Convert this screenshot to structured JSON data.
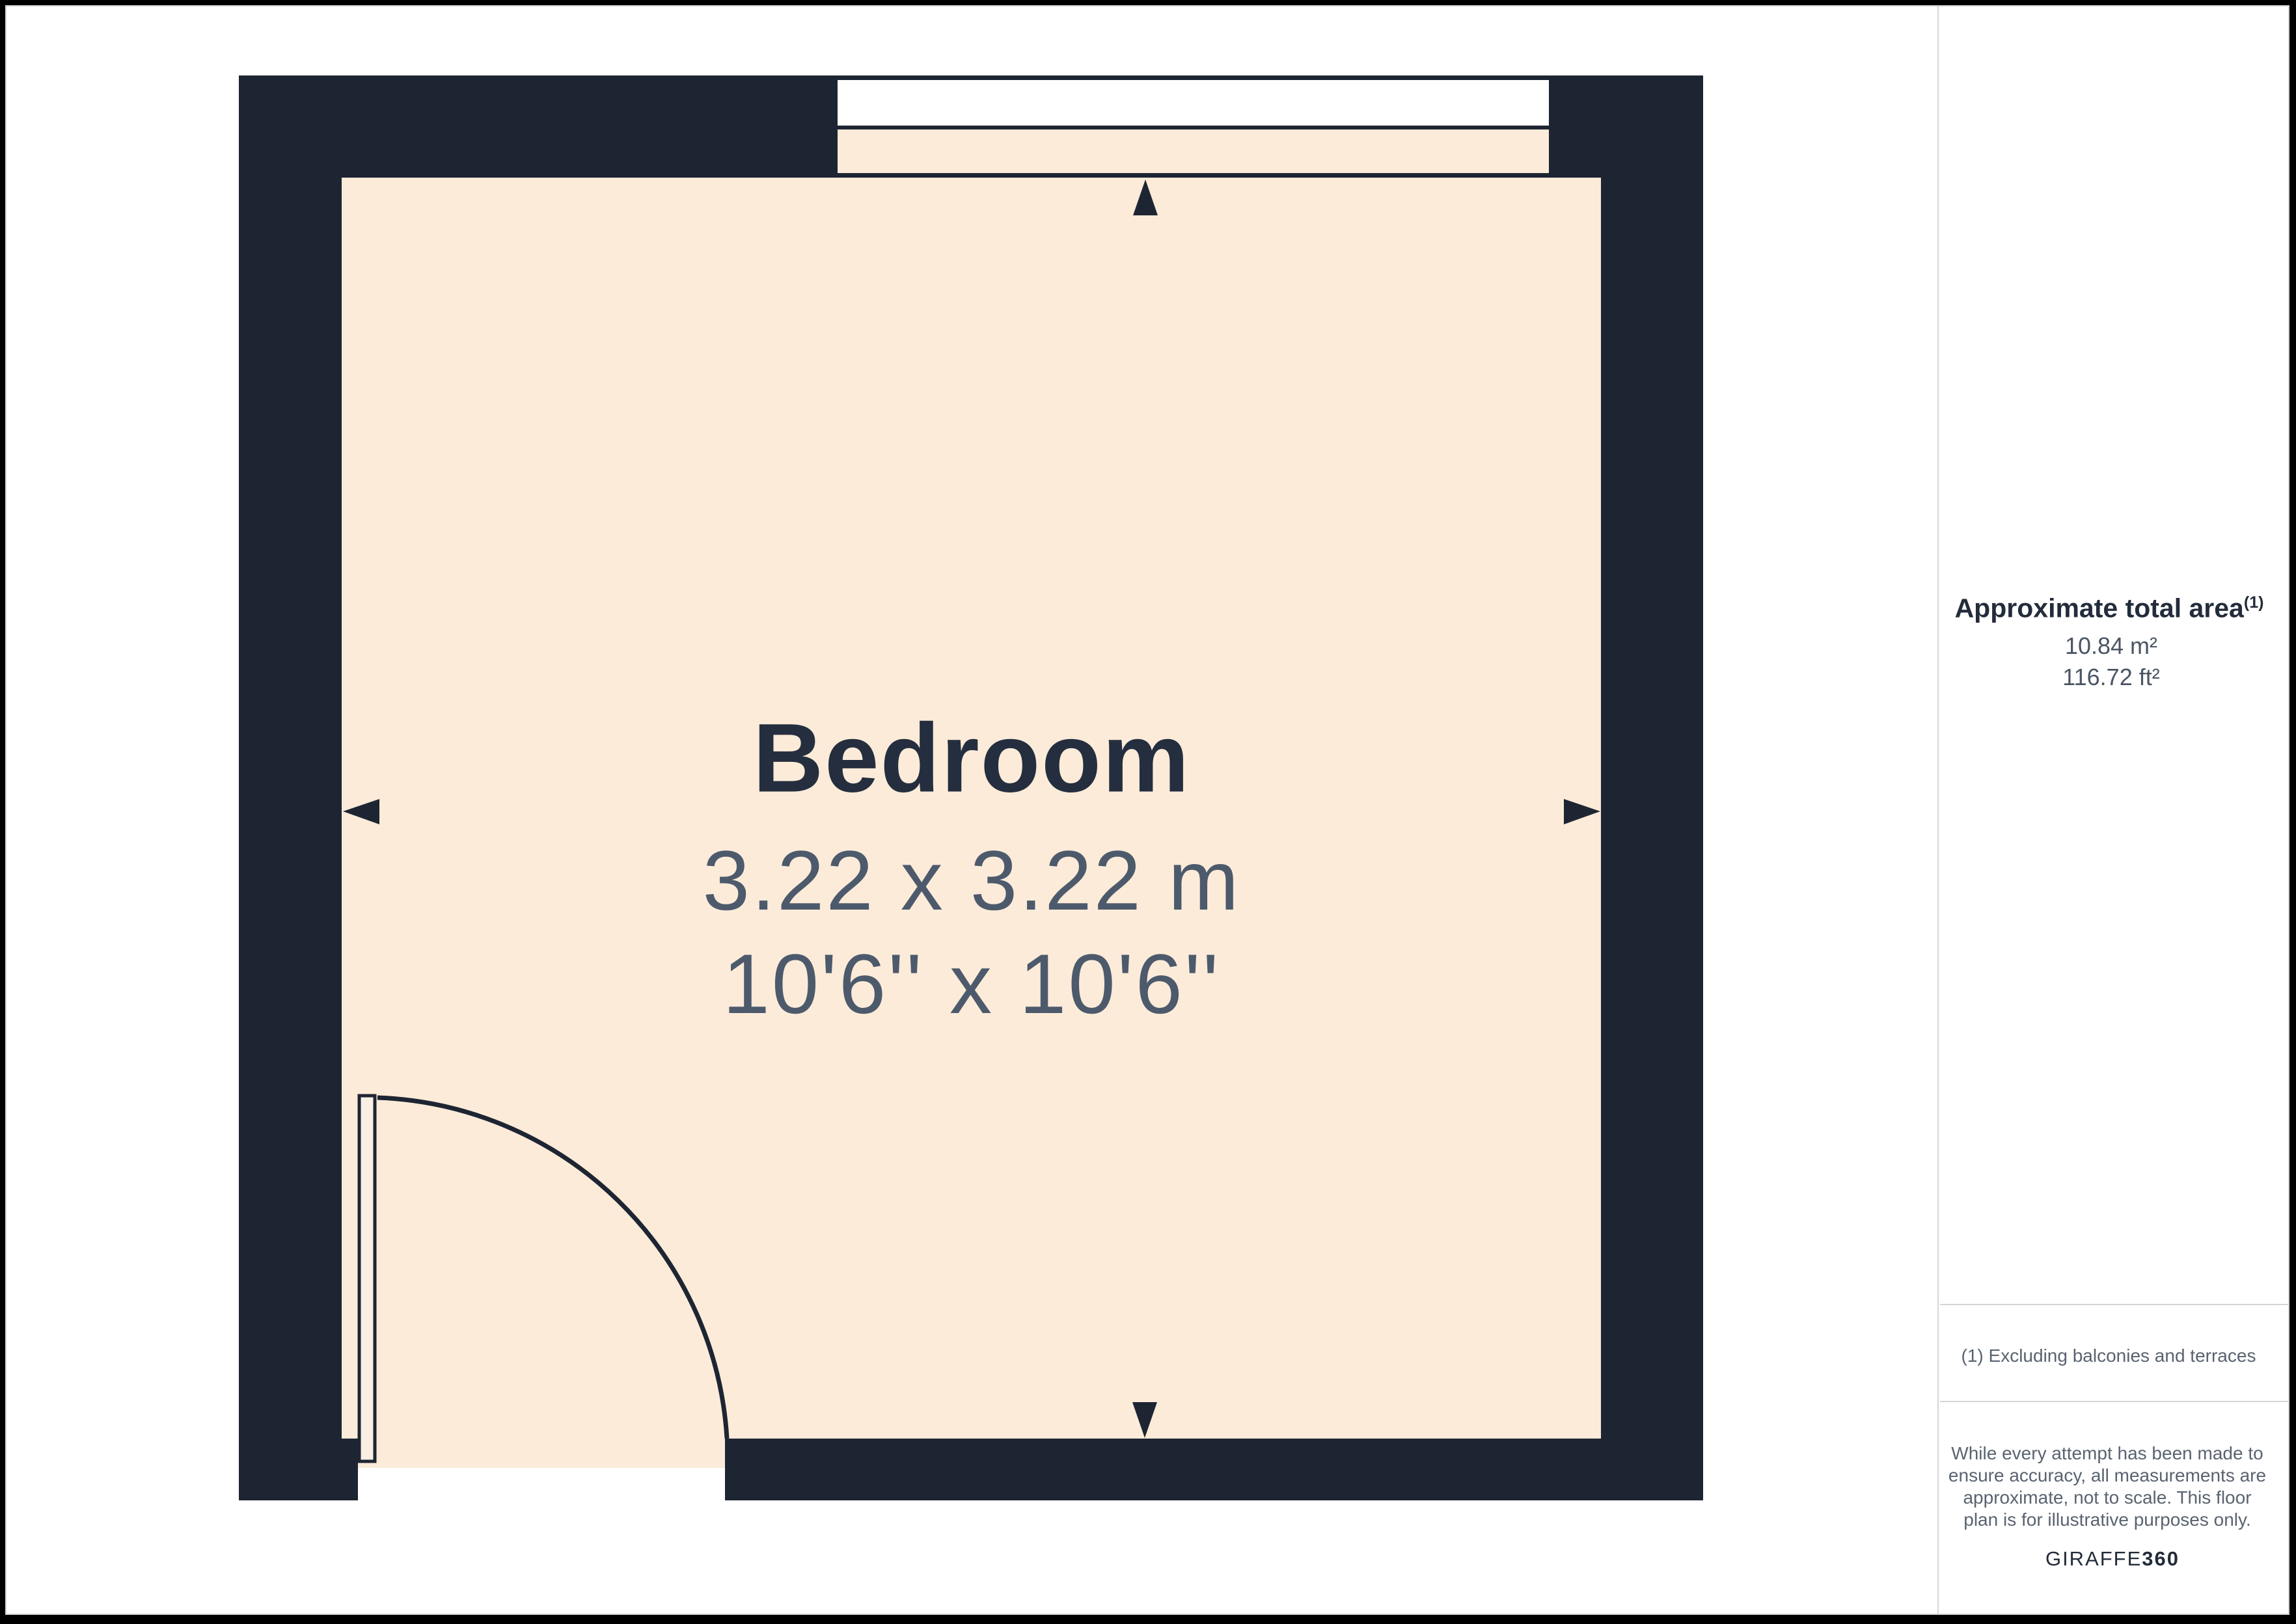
{
  "floorplan": {
    "room": {
      "name": "Bedroom",
      "dimensions_metric": "3.22 x 3.22 m",
      "dimensions_imperial": "10'6'' x 10'6''"
    },
    "features": [
      "window",
      "door"
    ],
    "arrow_icons": [
      "arrow-up",
      "arrow-down",
      "arrow-left",
      "arrow-right"
    ]
  },
  "sidebar": {
    "area_heading": "Approximate total area",
    "area_heading_sup": "(1)",
    "area_m2": "10.84 m²",
    "area_ft2": "116.72 ft²",
    "footnote": "(1) Excluding balconies and terraces",
    "disclaimer_lines": [
      "While every attempt has been made to",
      "ensure accuracy, all measurements are",
      "approximate, not to scale. This floor",
      "plan is for illustrative purposes only."
    ],
    "brand": {
      "name": "GIRAFFE",
      "suffix": "360"
    }
  },
  "colors": {
    "wall": "#1e2532",
    "floor": "#fcebd9",
    "window_glass": "#ffffff",
    "title_text": "#242e3e",
    "dimension_text": "#4d5a6c",
    "muted_text": "#5a6370",
    "divider": "#d6d6d6",
    "frame": "#000000"
  }
}
